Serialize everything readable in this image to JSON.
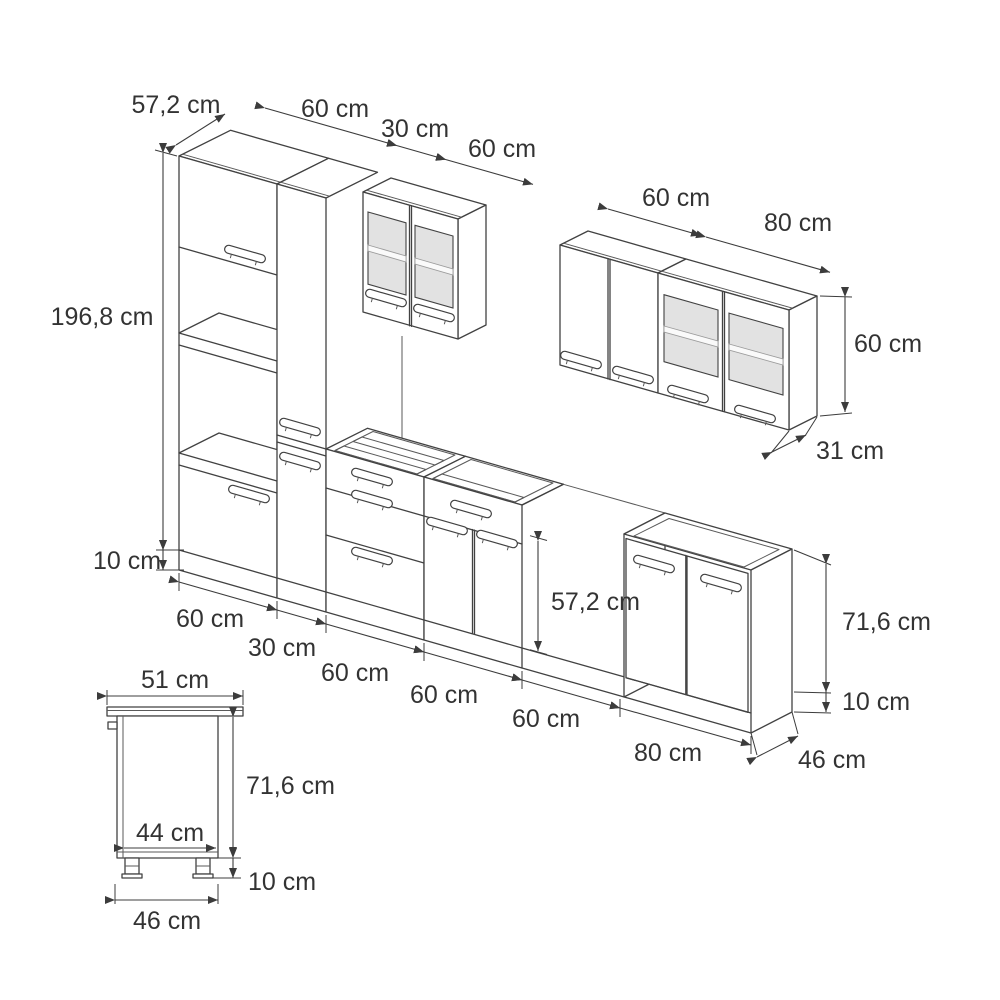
{
  "unit_suffix": "cm",
  "tall_group": {
    "depth_label": "57,2 cm",
    "height_label": "196,8 cm",
    "plinth_label": "10 cm",
    "width_labels": [
      "60 cm",
      "30 cm",
      "60 cm"
    ]
  },
  "wall_group": {
    "width_labels": [
      "60 cm",
      "80 cm"
    ],
    "height_label": "60 cm",
    "depth_label": "31 cm"
  },
  "base_run": {
    "width_labels": [
      "60 cm",
      "30 cm",
      "60 cm",
      "60 cm",
      "60 cm",
      "80 cm"
    ],
    "front_height_label": "57,2 cm",
    "body_height_label": "71,6 cm",
    "plinth_label": "10 cm",
    "depth_label": "46 cm"
  },
  "side_view": {
    "top_depth_label": "51 cm",
    "body_height_label": "71,6 cm",
    "inner_width_label": "44 cm",
    "plinth_label": "10 cm",
    "bottom_depth_label": "46 cm"
  }
}
